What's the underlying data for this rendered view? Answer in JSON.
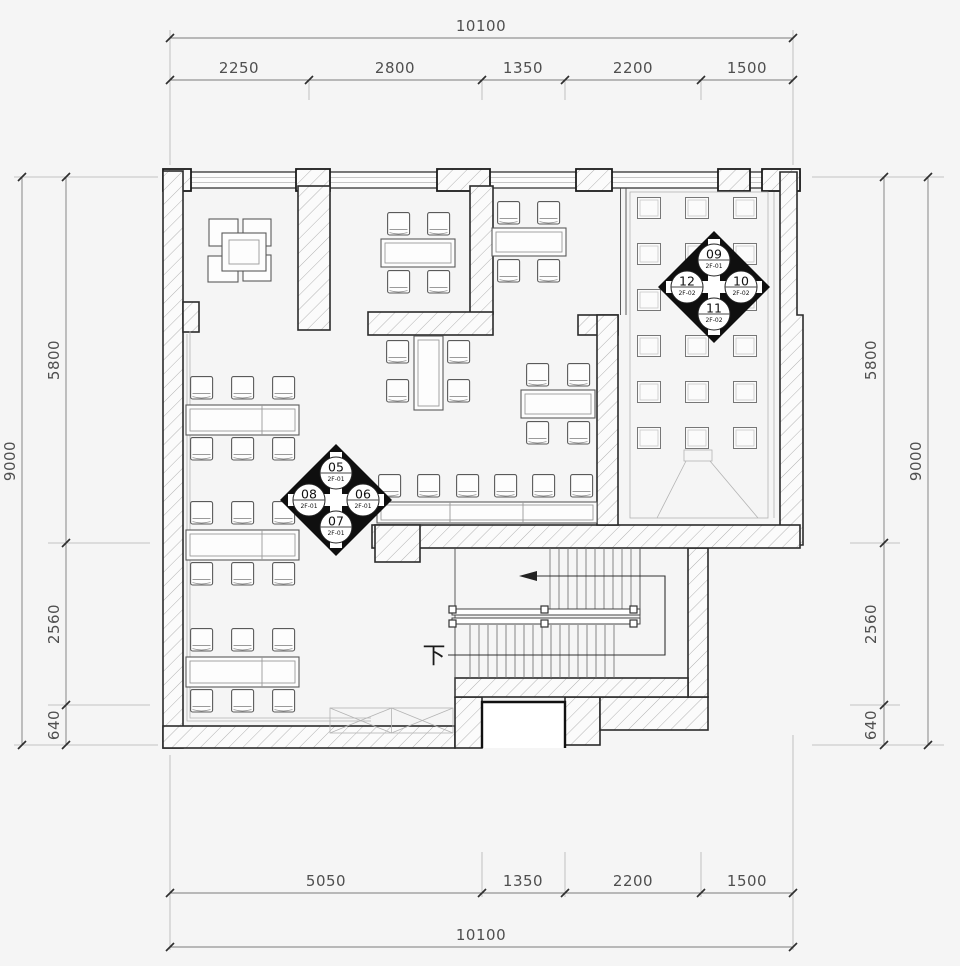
{
  "dimensions": {
    "top": {
      "total": "10100",
      "segments": [
        "2250",
        "2800",
        "1350",
        "2200",
        "1500"
      ]
    },
    "bottom": {
      "total": "10100",
      "segments": [
        "5050",
        "1350",
        "2200",
        "1500"
      ]
    },
    "left": {
      "total": "9000",
      "segments": [
        "5800",
        "2560",
        "640"
      ]
    },
    "right": {
      "total": "9000",
      "segments": [
        "5800",
        "2560",
        "640"
      ]
    }
  },
  "markers": {
    "a": {
      "top": {
        "num": "05",
        "sheet": "2F-01"
      },
      "right": {
        "num": "06",
        "sheet": "2F-01"
      },
      "bottom": {
        "num": "07",
        "sheet": "2F-01"
      },
      "left": {
        "num": "08",
        "sheet": "2F-01"
      }
    },
    "b": {
      "top": {
        "num": "09",
        "sheet": "2F-01"
      },
      "right": {
        "num": "10",
        "sheet": "2F-02"
      },
      "bottom": {
        "num": "11",
        "sheet": "2F-02"
      },
      "left": {
        "num": "12",
        "sheet": "2F-02"
      }
    }
  },
  "stairs": {
    "down_label": "下"
  },
  "palette": {
    "wall_line": "#2b2b2b",
    "hatch": "#b3b3b3",
    "dim_text": "#4f4f4f",
    "marker_fill": "#0f0f0f",
    "paper": "#f5f5f5"
  }
}
